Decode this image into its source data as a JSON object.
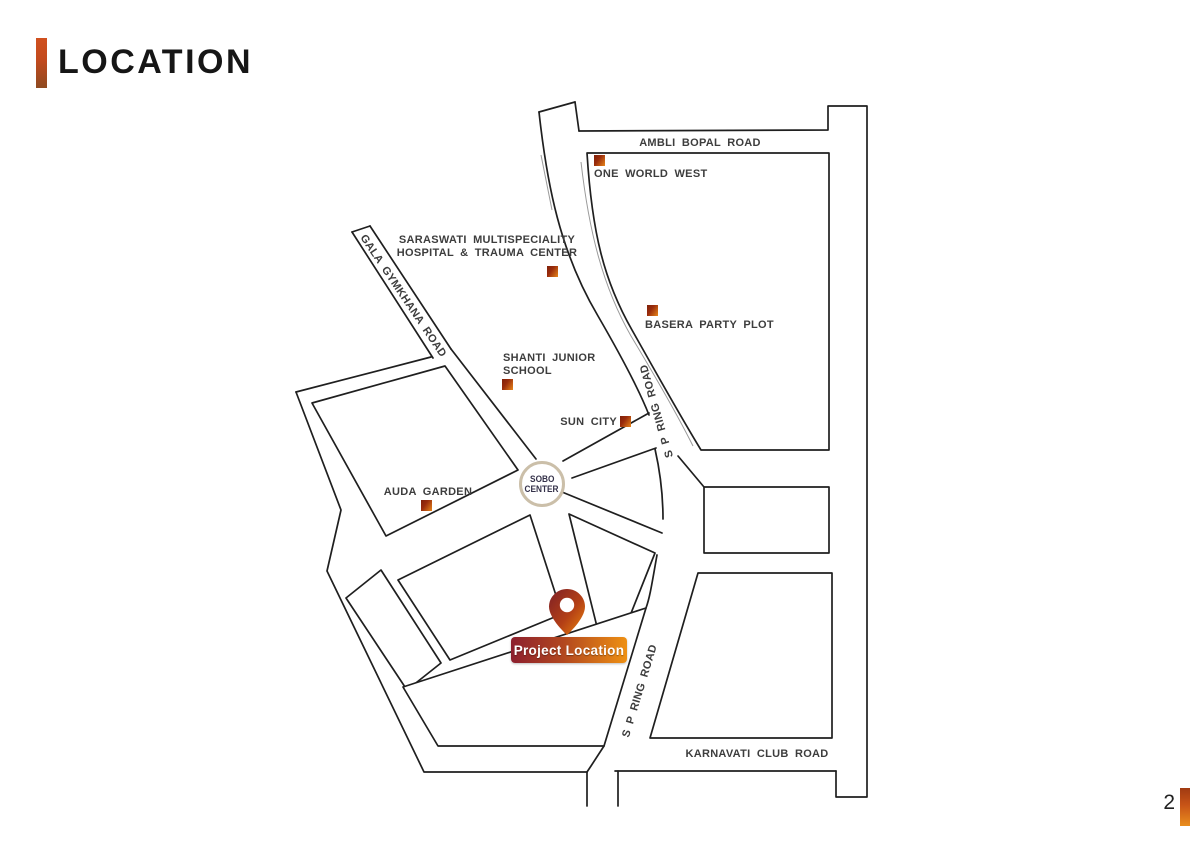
{
  "slide": {
    "title": "LOCATION",
    "page_number": "2"
  },
  "colors": {
    "accent_gradient_top": "#d0501f",
    "accent_gradient_bottom": "#8e4a20",
    "badge_gradient_left": "#8c1f2e",
    "badge_gradient_right": "#ee9013",
    "marker_dark": "#7e2009",
    "marker_orange": "#e8861a",
    "road_line": "#1f1f1f",
    "sobo_ring": "#cbbfa9",
    "label_text": "#3d3d3d"
  },
  "map": {
    "road_labels": {
      "ambli": "AMBLI BOPAL ROAD",
      "gala": "GALA GYMKHANA ROAD",
      "sp_upper": "S P RING ROAD",
      "sp_lower": "S P RING ROAD",
      "karnavati": "KARNAVATI CLUB ROAD"
    },
    "places": {
      "one_world_west": "ONE WORLD WEST",
      "saraswati_line1": "SARASWATI MULTISPECIALITY",
      "saraswati_line2": "HOSPITAL & TRAUMA CENTER",
      "basera": "BASERA PARTY PLOT",
      "shanti_line1": "SHANTI JUNIOR",
      "shanti_line2": "SCHOOL",
      "sun_city": "SUN CITY",
      "auda": "AUDA GARDEN",
      "sobo_line1": "SOBO",
      "sobo_line2": "CENTER"
    },
    "project": {
      "label": "Project Location"
    }
  }
}
